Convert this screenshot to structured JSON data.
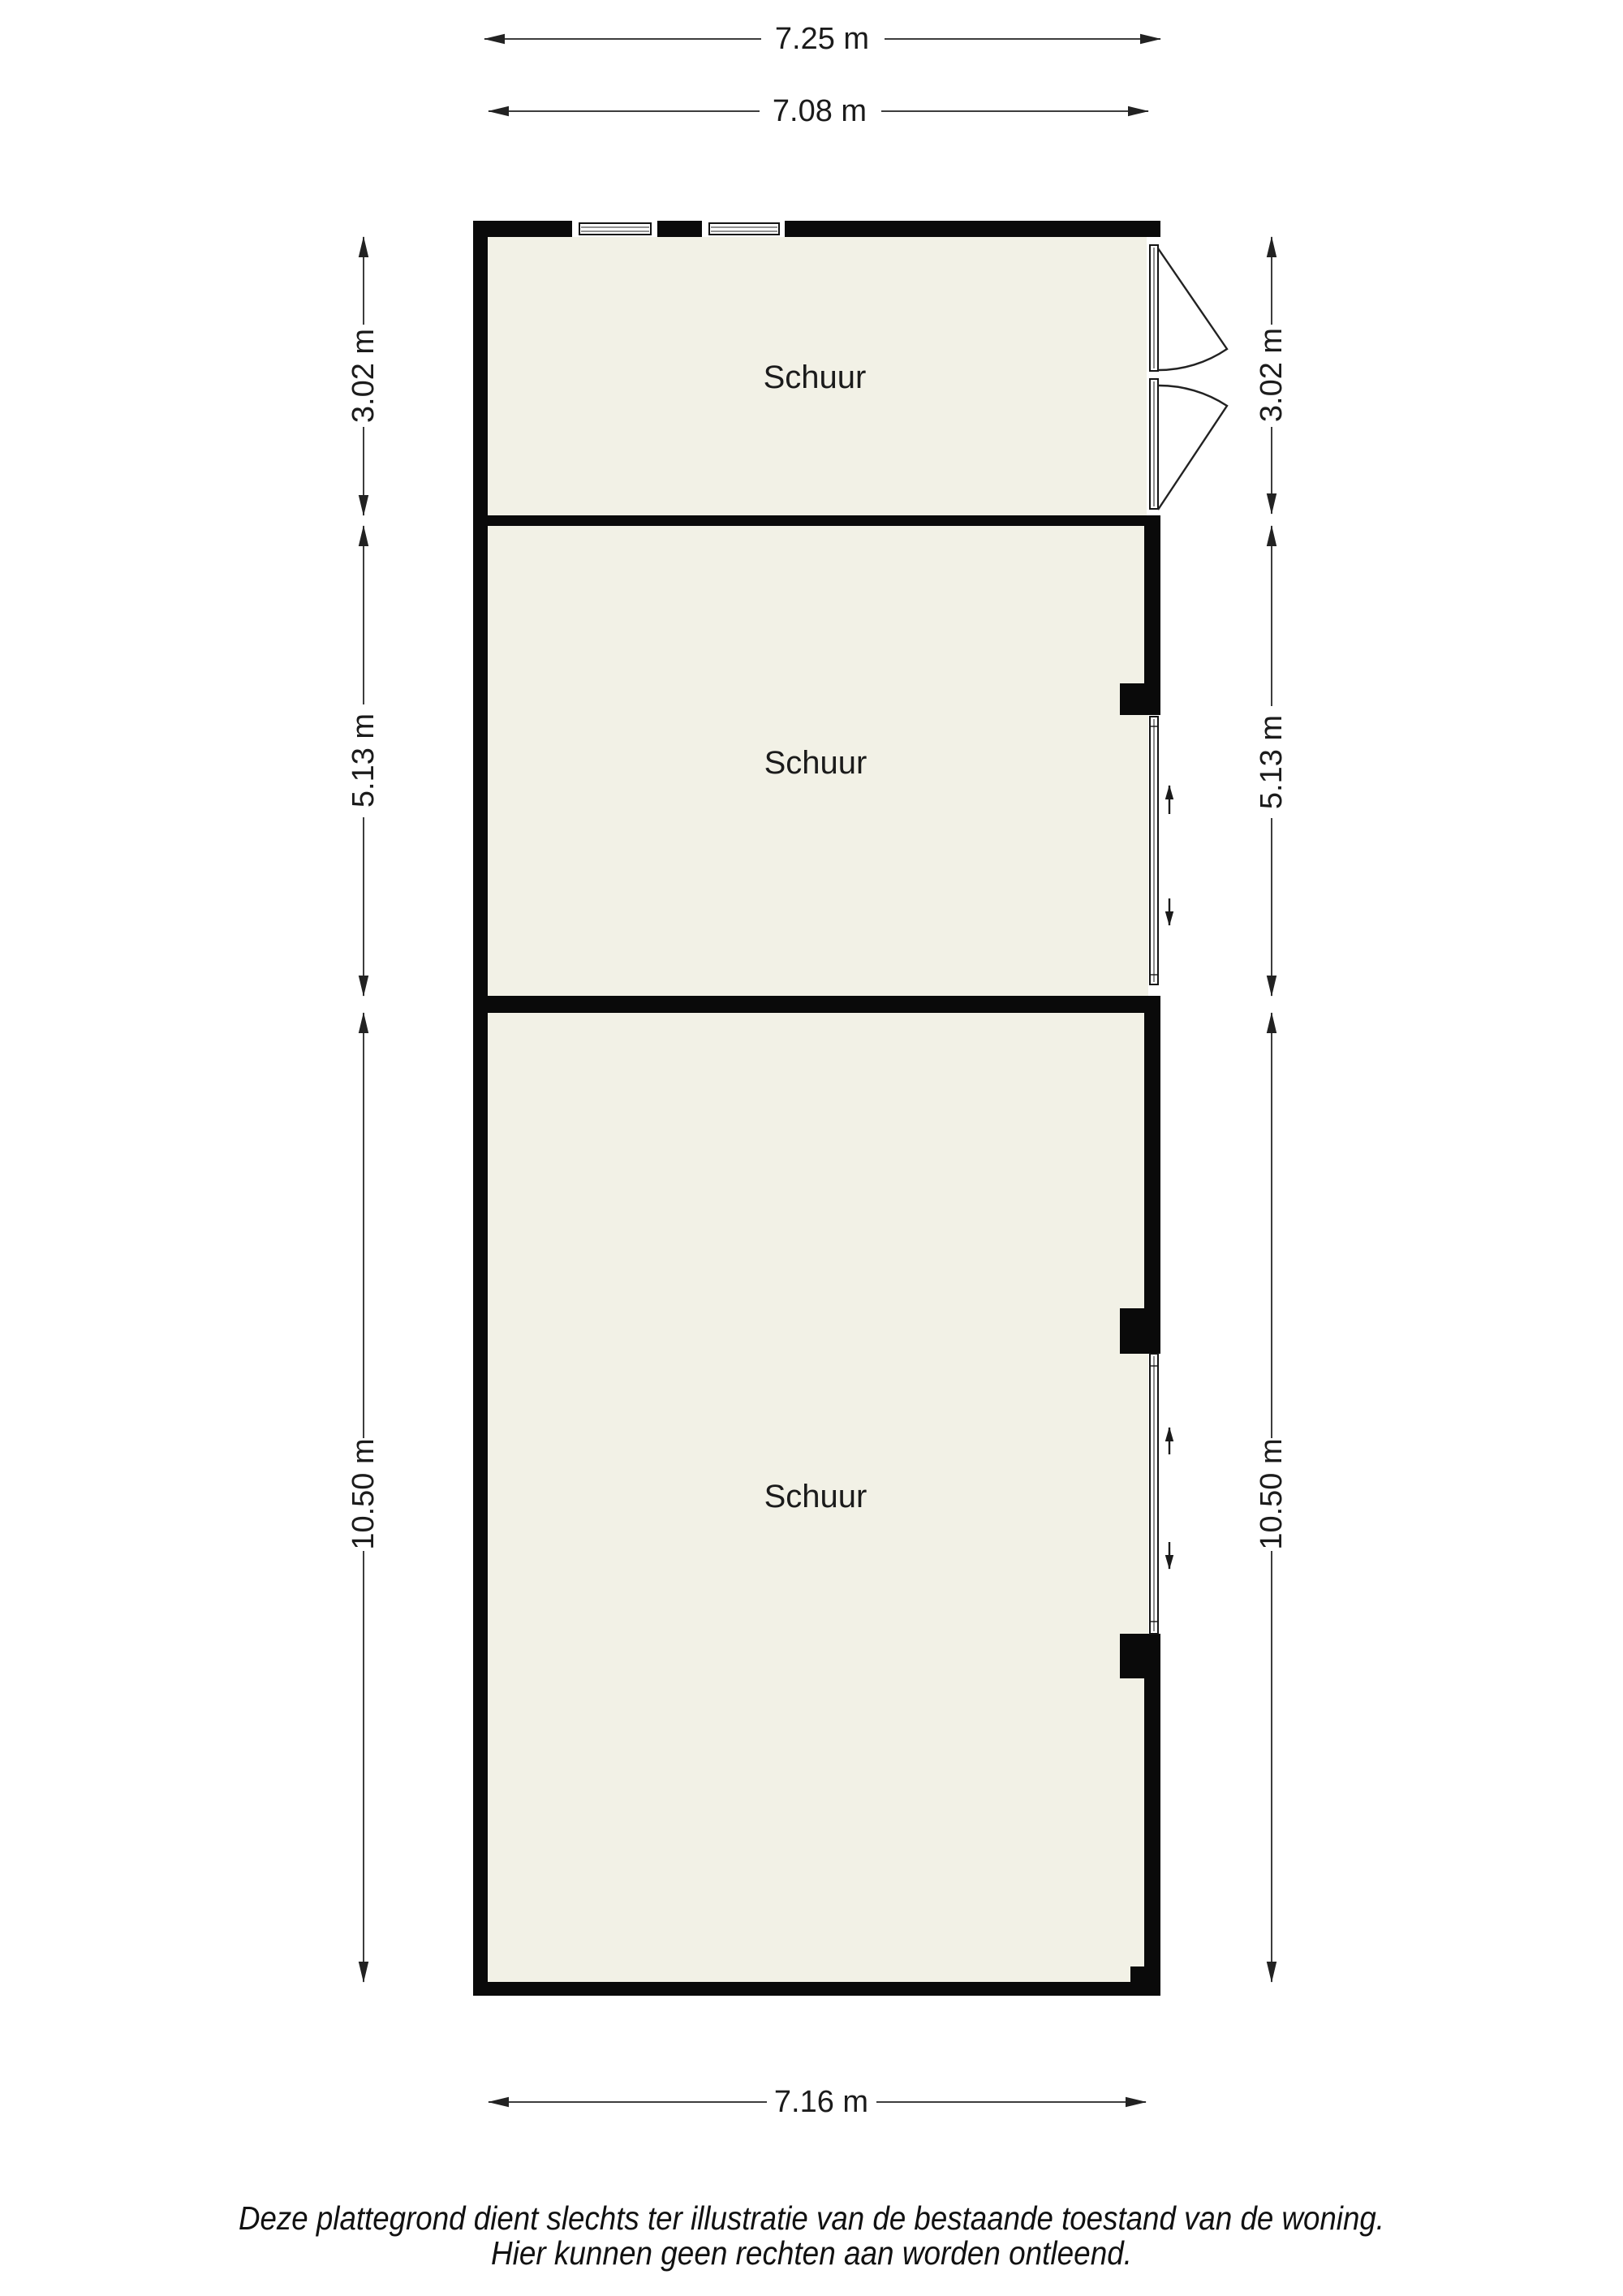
{
  "page": {
    "background": "#ffffff"
  },
  "floorplan": {
    "rooms": [
      {
        "label": "Schuur"
      },
      {
        "label": "Schuur"
      },
      {
        "label": "Schuur"
      }
    ],
    "dimensions": {
      "top_outer_width": "7.25 m",
      "top_inner_width": "7.08 m",
      "left": [
        "3.02 m",
        "5.13 m",
        "10.50 m"
      ],
      "right": [
        "3.02 m",
        "5.13 m",
        "10.50 m"
      ],
      "bottom_inner_width": "7.16 m"
    },
    "disclaimer": {
      "line1": "Deze plattegrond dient slechts ter illustratie van de bestaande toestand van de woning.",
      "line2": "Hier kunnen geen rechten aan worden ontleend."
    },
    "colors": {
      "wall": "#0a0a0a",
      "floor": "#f2f1e6",
      "dim_line": "#3d3d3d",
      "text": "#1b1b1b"
    }
  }
}
